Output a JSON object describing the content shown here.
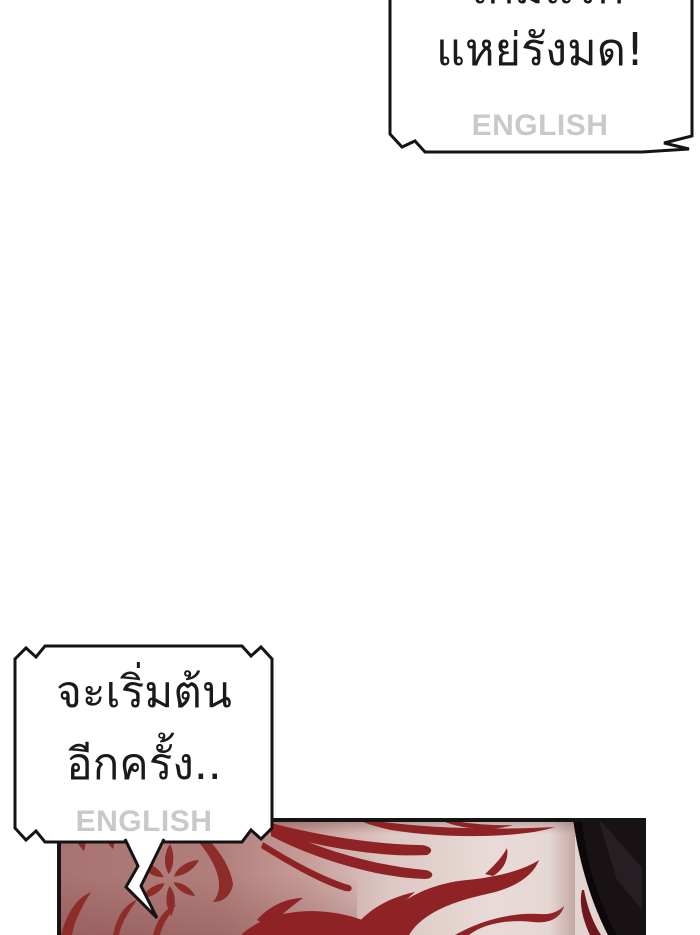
{
  "comic": {
    "top_bubble": {
      "line1": "เกมแรก",
      "line2": "แหย่รังมด!",
      "watermark": "ENGLISH"
    },
    "bottom_bubble": {
      "line1": "จะเริ่มต้น",
      "line2": "อีกครั้ง..",
      "watermark": "ENGLISH"
    },
    "palette": {
      "page_bg": "#ffffff",
      "ink": "#141414",
      "bubble_fill": "#ffffff",
      "watermark_gray": "#c9c9c9",
      "skin_light": "#e8dbd7",
      "skin_shadow": "#dcc7c3",
      "blush_mauve": "#b2807c",
      "marking_red": "#8e2225",
      "splat_red": "#8c2d2a",
      "hair_black": "#181215",
      "hair_highlight": "#261e22",
      "hair_red": "#6e181d"
    }
  }
}
